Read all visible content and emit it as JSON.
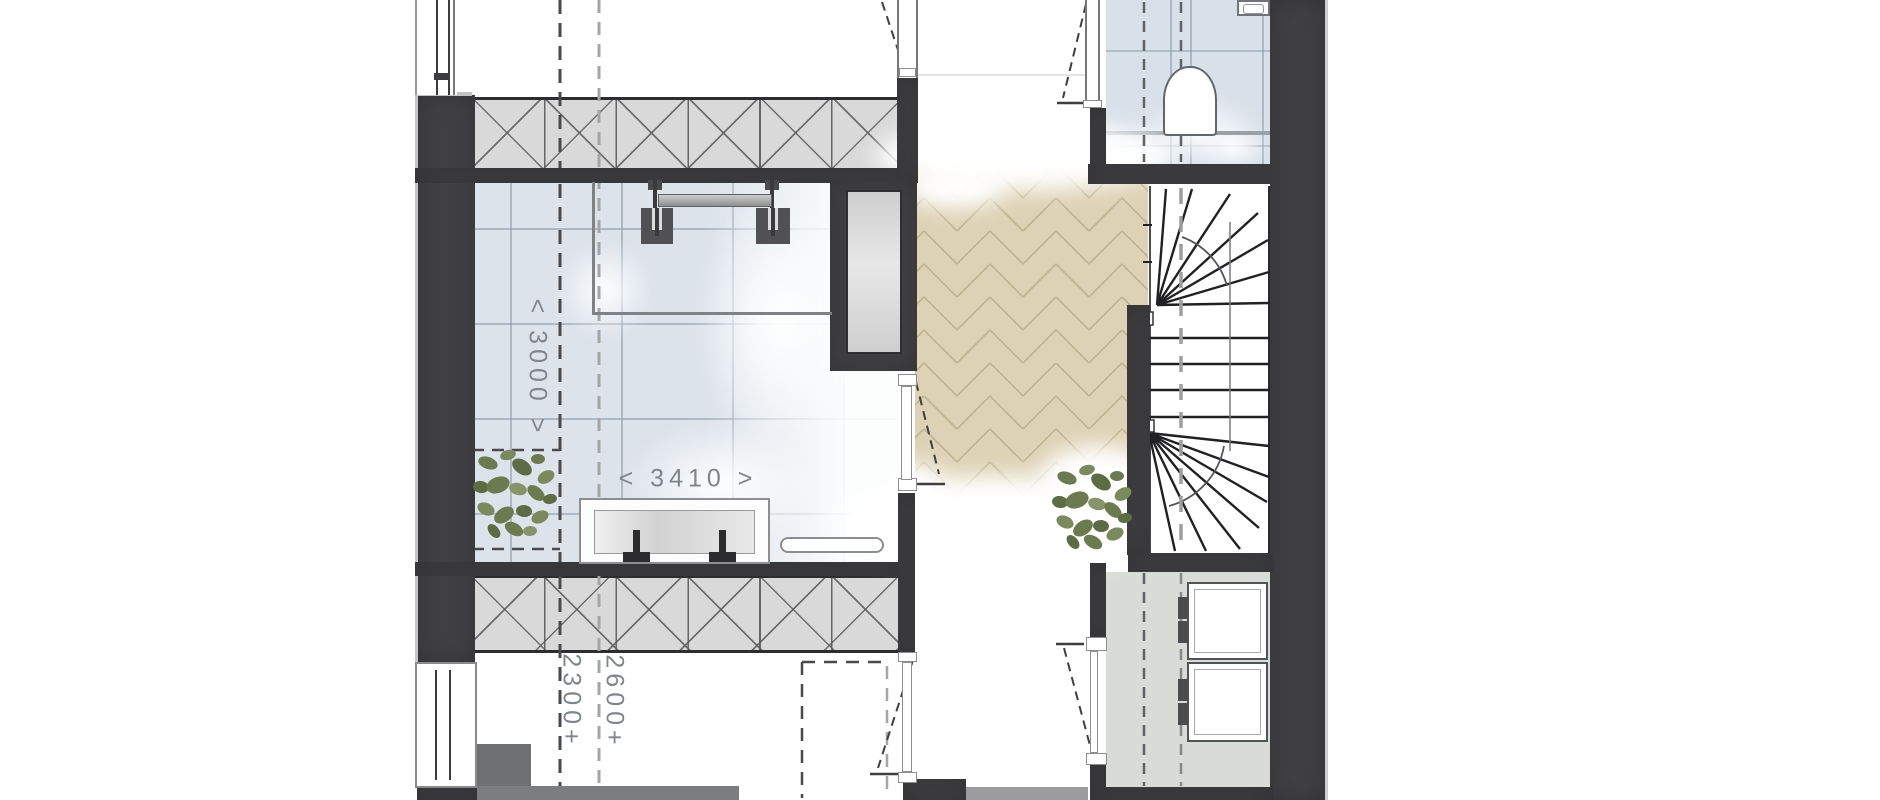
{
  "plan": {
    "drawing_label": "",
    "fixtures": [
      "spiral-staircase",
      "toilet",
      "washbasin",
      "appliance-stack",
      "clothes-rail",
      "sideboard",
      "radiator",
      "potted-plant",
      "herringbone-parquet",
      "tiled-floor",
      "insulation-hatch-wall",
      "roof-slope-dash-line",
      "door-swing"
    ]
  },
  "dimensions": {
    "room_width_label": "< 3000 >",
    "room_length_label": "< 3410 >",
    "ceiling_height_label_1": "2300+",
    "ceiling_height_label_2": "2600+"
  },
  "colors": {
    "wall": "#414144",
    "hatch": "#d9d9d9",
    "tile": "#dce3ea",
    "parquet": "#ddd2b5",
    "parquet_line": "#bfb391",
    "laundry_floor": "#d8dbd6",
    "plant_green": "#6c7a4f",
    "dim": "#7f858b"
  }
}
